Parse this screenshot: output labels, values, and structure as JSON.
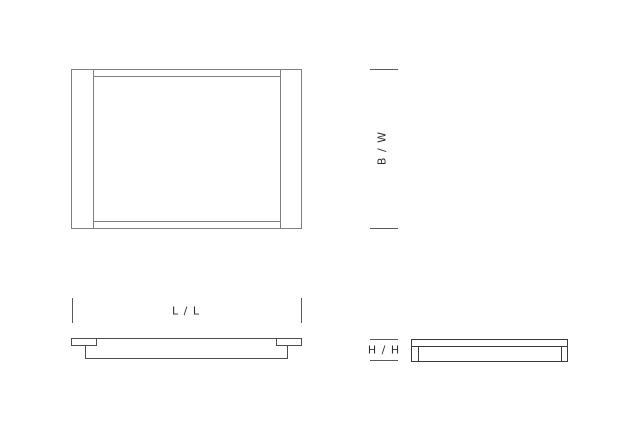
{
  "drawing": {
    "type": "product-dimension-diagram",
    "views": {
      "plan": "top-view",
      "front": "front-elevation-view",
      "side": "side-elevation-view"
    },
    "dimensions": {
      "width_label": "B / W",
      "length_label": "L / L",
      "height_label": "H / H"
    },
    "colors": {
      "background": "#ffffff",
      "plan_line": "#7f7f82",
      "front_line": "#4c4c4e",
      "side_line": "#3a3a3c",
      "tick_line": "#5a5a5c",
      "label_text": "#2e2e2e"
    }
  }
}
